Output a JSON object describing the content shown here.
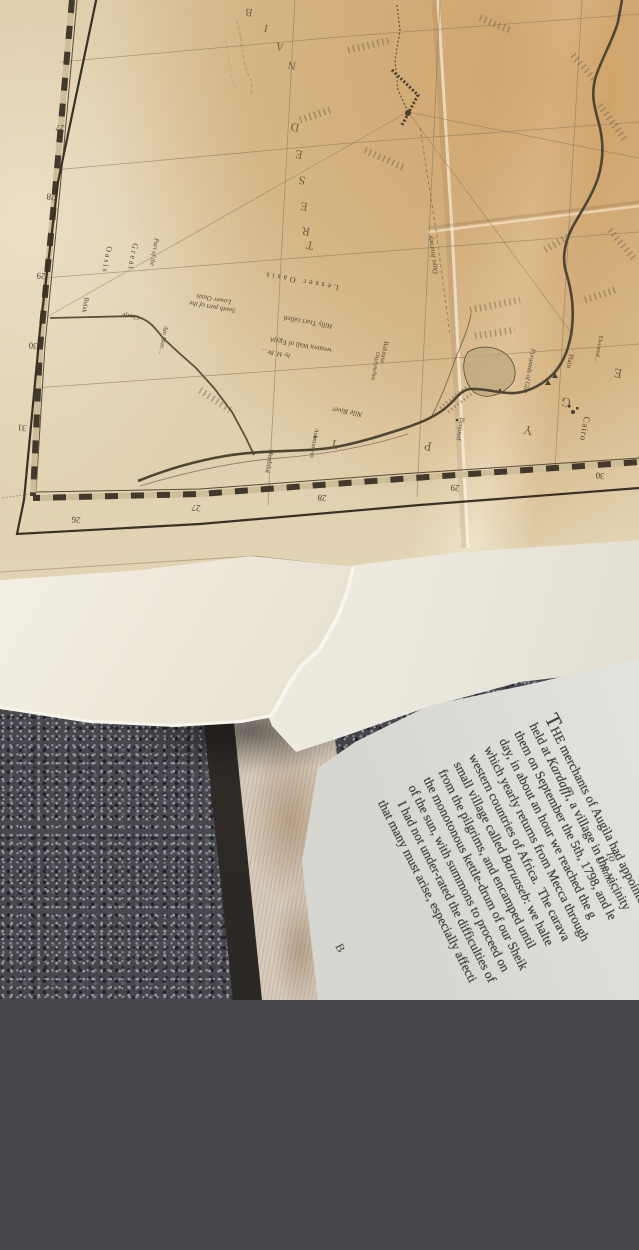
{
  "map": {
    "region_letters": {
      "libyan": [
        "B",
        "I",
        "A",
        "N"
      ],
      "desert": [
        "D",
        "E",
        "S",
        "E",
        "R",
        "T"
      ],
      "egypt": [
        "E",
        "G",
        "Y",
        "P",
        "T"
      ]
    },
    "ticks_left": [
      "27",
      "28",
      "29",
      "30",
      "31"
    ],
    "ticks_bottom": [
      "26",
      "27",
      "28",
      "29",
      "30"
    ],
    "labels": [
      {
        "text": "Lesser Oasis"
      },
      {
        "text": "South part of the\nLower Oasis"
      },
      {
        "text": "Part of the"
      },
      {
        "text": "Great"
      },
      {
        "text": "Oasis"
      },
      {
        "text": "Bulak"
      },
      {
        "text": "Charje"
      },
      {
        "text": "Ain Dize…"
      },
      {
        "text": "Hilly Tract called"
      },
      {
        "text": "western Wall of Egypt"
      },
      {
        "text": "by M. Br…"
      },
      {
        "text": "Bahnasa"
      },
      {
        "text": "Oxyrynchus"
      },
      {
        "text": "Nile River"
      },
      {
        "text": "Monfalut"
      },
      {
        "text": "Ashmunein"
      },
      {
        "text": "Benjusef"
      },
      {
        "text": "Cairo"
      },
      {
        "text": "Pyramids of Gize"
      },
      {
        "text": "Plain"
      },
      {
        "text": "Elevated…"
      },
      {
        "text": "Days Journey"
      }
    ]
  },
  "book": {
    "running_head": "To Umme…",
    "paragraph_lines": [
      "THE merchants of Augila had appointe",
      "held at Kardaffi, a village in the vicinity",
      "them on September the 5th, 1798, and le",
      "day, in about an hour we reached the g",
      "which yearly returns from Mecca through",
      "western countries of Africa.  The carava",
      "small village called Baruaseb: we halte",
      "from the pilgrims, and encamped until",
      "the monotonous kettle-drum of our Sheik",
      "of the sun, with summons to proceed on",
      "   I had not under-rated the difficulties of",
      "that many must arise, especially affecti"
    ],
    "italic_names": [
      "Kardaffi",
      "Baruaseb"
    ],
    "signature_mark": "B"
  }
}
